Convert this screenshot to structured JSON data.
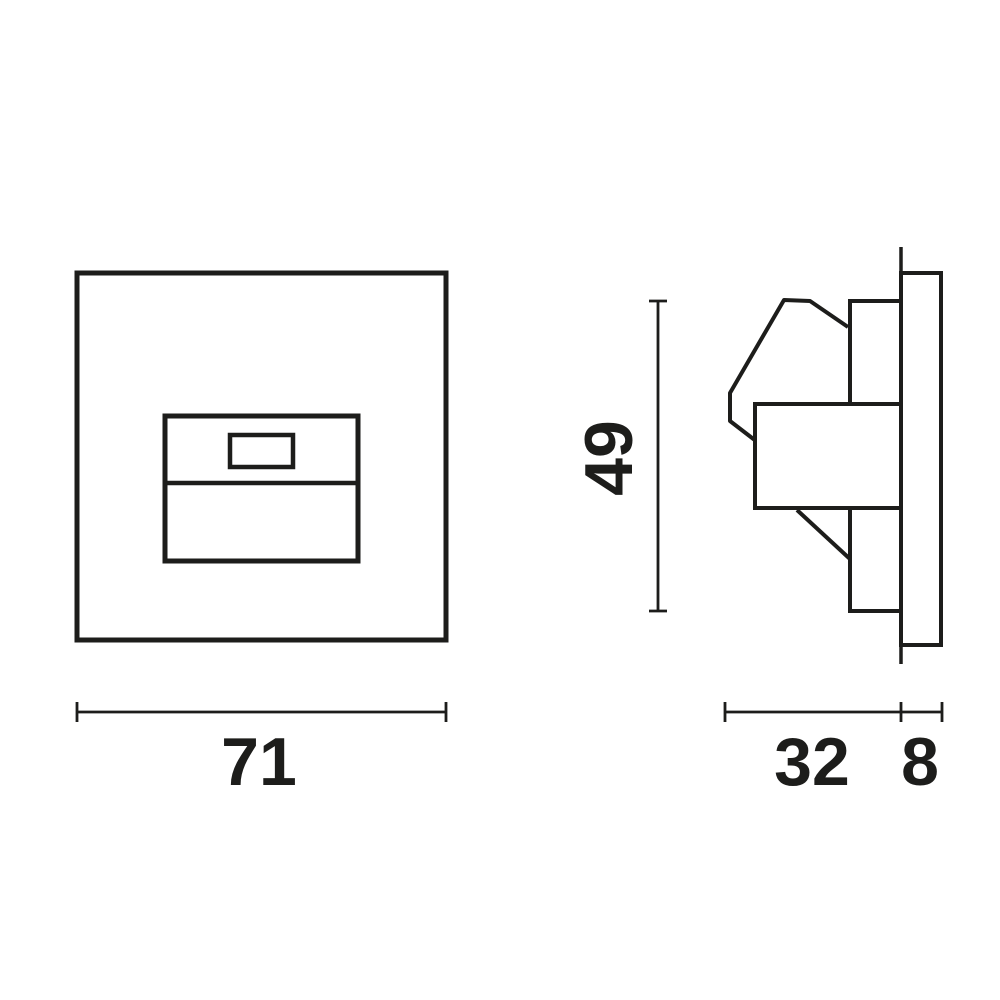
{
  "diagram": {
    "kind": "technical-dimension-drawing",
    "views": {
      "front": "square faceplate with recessed module window",
      "side": "profile with sensor head, mounting body and faceplate"
    },
    "labels": {
      "front_width": "71",
      "body_height": "49",
      "recess_depth": "32",
      "plate_depth": "8"
    },
    "colors": {
      "line": "#1d1d1b",
      "background": "#ffffff"
    }
  }
}
